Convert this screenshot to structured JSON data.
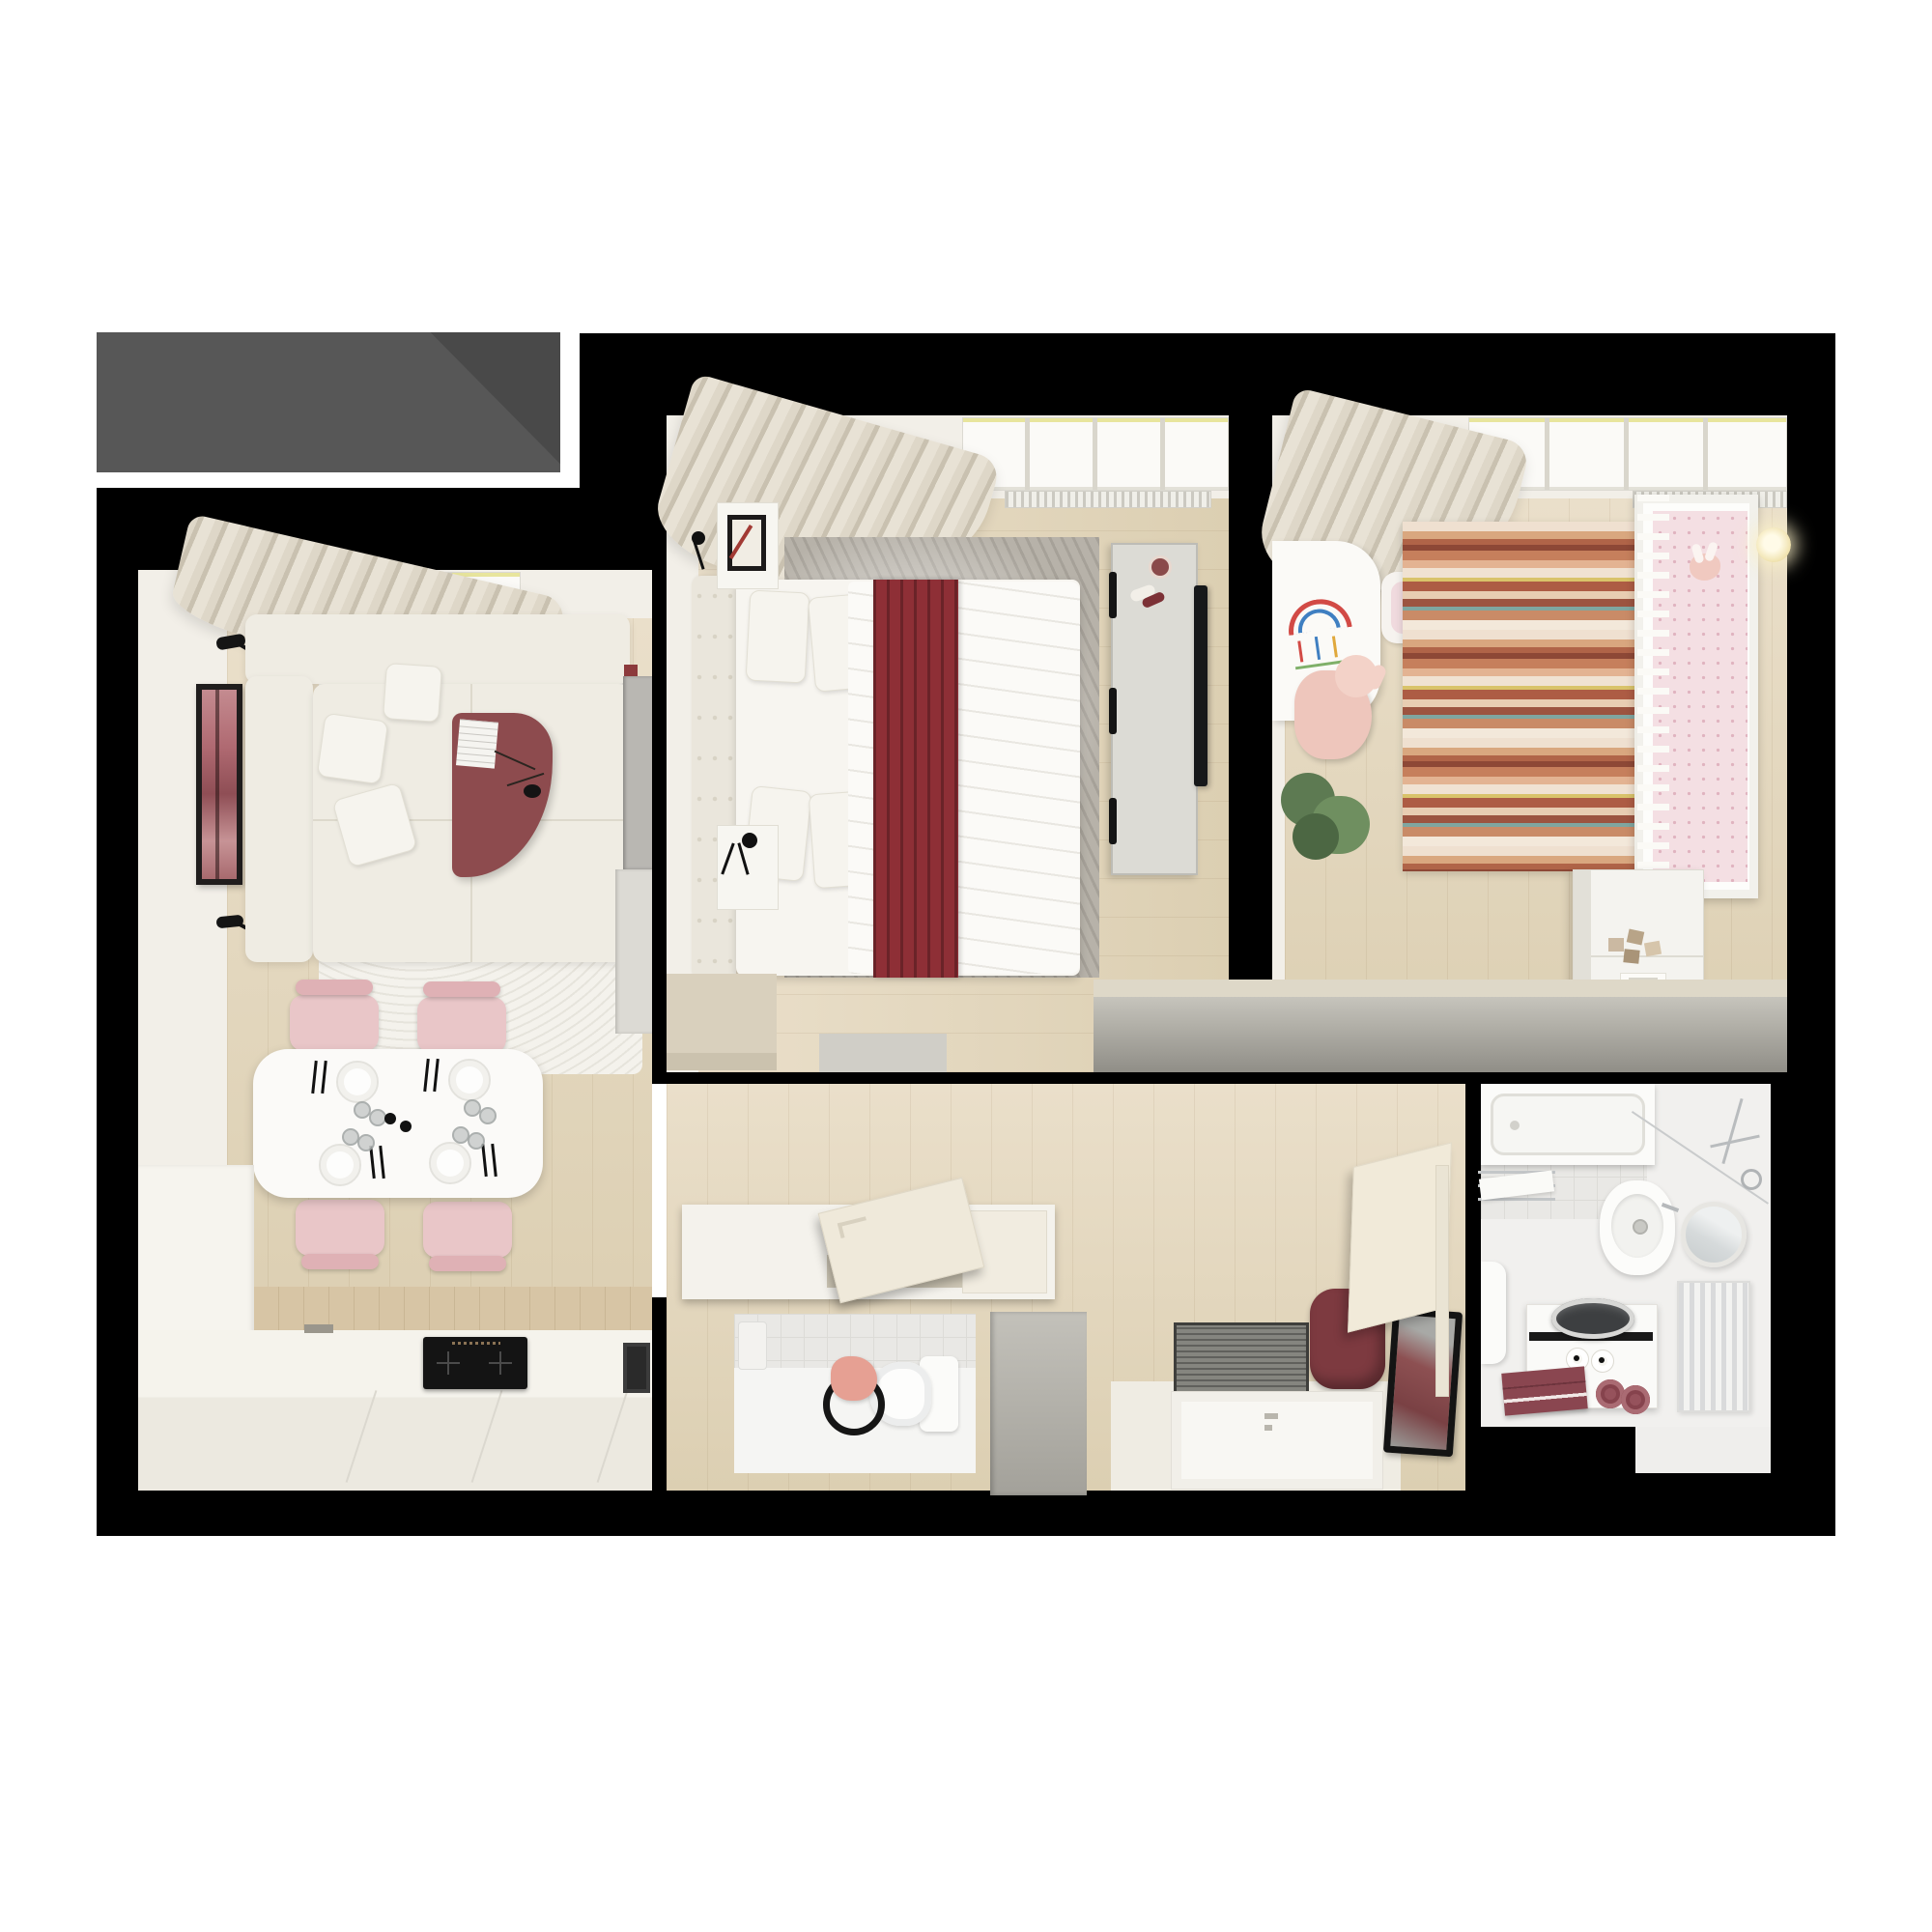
{
  "scene": {
    "kind": "photorealistic top-down 3D floor plan rendering of an apartment",
    "visible_text": "",
    "header_block": {
      "shape": "rectangle with diagonal shadow fold",
      "position": "top-left"
    }
  },
  "palette": {
    "page": "#ffffff",
    "wall": "#000000",
    "grayBox": "#575757",
    "grayBoxShadow": "#494949",
    "cream": "#f2efe8",
    "wood1": "#eadfca",
    "wood2": "#dccfb2",
    "maroon": "#8d4b4e",
    "redBlanket": "#8e2f36",
    "pink": "#e9c6c8",
    "plushPink": "#eec6bc",
    "benchGray": "#b8b6ae",
    "rugGray": "#b7b2a9",
    "matGray": "#85857f",
    "plantGreen": "#5d7a52"
  },
  "rooms": [
    {
      "id": "living-kitchen",
      "furniture": [
        "corner-sofa-white",
        "throw-pillows",
        "wall-lamp x2",
        "tall-picture-frame-pink-art",
        "white-fur-rug",
        "maroon-curved-coffee-table",
        "magazine",
        "black-branch-vase",
        "dining-table-white",
        "pink-chairs x4",
        "place-settings x4 (plate, cutlery, glasses)",
        "salt-and-pepper",
        "kitchen-counter",
        "induction-hob-black",
        "wood-backsplash",
        "tall-cabinet",
        "leaning-art-frame",
        "curtain",
        "window-with-radiator",
        "gray-wardrobe-panel",
        "red-wall-object"
      ]
    },
    {
      "id": "bedroom",
      "furniture": [
        "double-bed-white-duvet",
        "red-runner-blanket",
        "tufted-headboard",
        "pillows x4",
        "nightstand x2",
        "black-wall-lamp x2",
        "standing-photo-frame",
        "gray-area-rug",
        "wardrobe-with-tv",
        "tv-panel",
        "foot-bench",
        "low-bench",
        "curtain",
        "window-with-radiator"
      ]
    },
    {
      "id": "nursery",
      "furniture": [
        "crib-with-rails",
        "pink-polka-mattress",
        "bunny-plush",
        "striped-rug",
        "kids-table-with-drawing",
        "bunny-chair",
        "pink-plush-toy",
        "potted-plant",
        "dresser-changing-table",
        "toy-blocks",
        "picture-book",
        "cards",
        "wall-sconce-glowing",
        "long-storage-bench",
        "curtain",
        "window-with-radiator"
      ]
    },
    {
      "id": "hallway-entrance",
      "furniture": [
        "storage-bench-with-open-hatch",
        "gray-entry-closet",
        "ribbed-doormat",
        "maroon-pouf",
        "black-frame-mirror",
        "wall-shoe-cabinet-open-flap",
        "front-door-open"
      ]
    },
    {
      "id": "wc",
      "furniture": [
        "toilet",
        "toilet-paper-holder",
        "pink-towel-on-ring",
        "tiled-wall"
      ]
    },
    {
      "id": "bathroom",
      "furniture": [
        "bathtub",
        "shower-set-chrome",
        "glass-screen",
        "towel-rail-with-towel",
        "washbasin",
        "round-mirror",
        "ladder-radiator",
        "top-load-washer-unit",
        "toilet-paper-rolls x2",
        "maroon-towels",
        "toilet-partial",
        "tiled-walls"
      ]
    }
  ]
}
